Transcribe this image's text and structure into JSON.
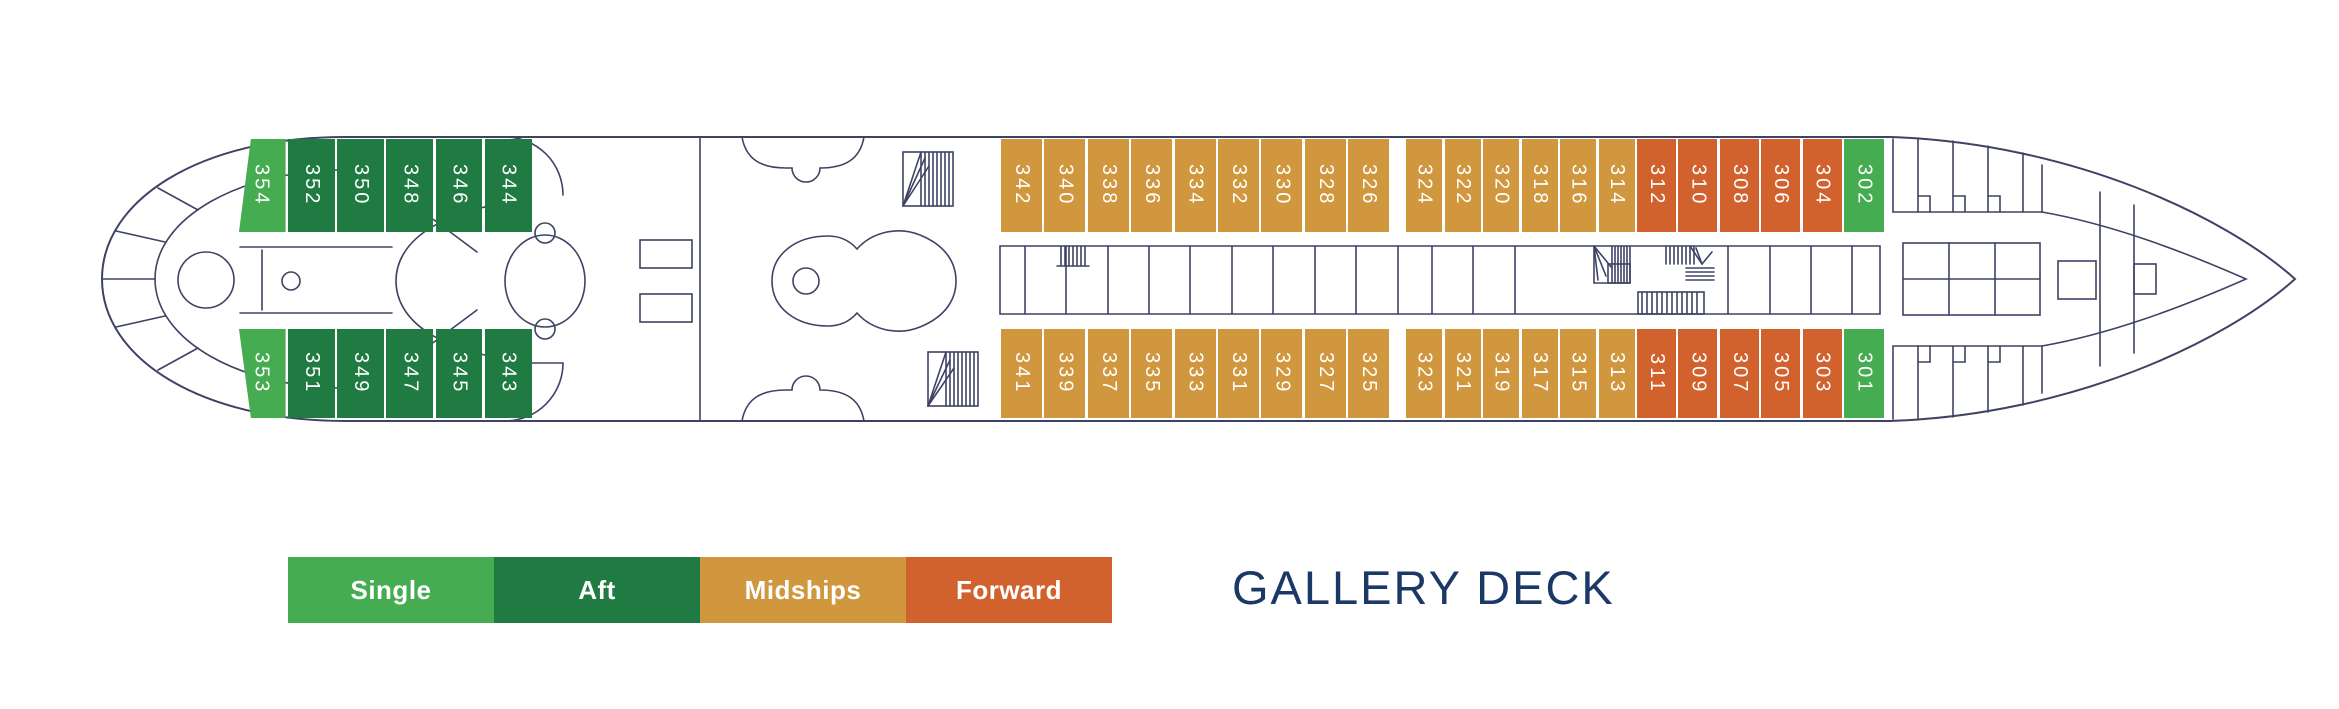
{
  "deck": {
    "title": "GALLERY DECK"
  },
  "colors": {
    "single": "#45AC51",
    "aft": "#1F7B41",
    "midships": "#D0973E",
    "forward": "#D1622E",
    "outline": "#3E4365",
    "title": "#1B3867"
  },
  "legend": {
    "items": [
      {
        "label": "Single",
        "category": "single"
      },
      {
        "label": "Aft",
        "category": "aft"
      },
      {
        "label": "Midships",
        "category": "midships"
      },
      {
        "label": "Forward",
        "category": "forward"
      }
    ]
  },
  "cabin_rows": [
    {
      "side": "port-top",
      "y": 139,
      "height": 93,
      "groups": [
        {
          "category": "single",
          "start": 236,
          "pitch": 52,
          "slant": "top-left",
          "cabins": [
            "354"
          ]
        },
        {
          "category": "aft",
          "start": 288,
          "pitch": 49.2,
          "cabins": [
            "352",
            "350",
            "348",
            "346",
            "344"
          ]
        },
        {
          "category": "midships",
          "start": 1001,
          "pitch": 43.4,
          "cabins": [
            "342",
            "340",
            "338",
            "336",
            "334",
            "332",
            "330",
            "328",
            "326"
          ]
        },
        {
          "category": "midships",
          "start": 1406,
          "pitch": 38.5,
          "cabins": [
            "324",
            "322",
            "320",
            "318",
            "316",
            "314"
          ]
        },
        {
          "category": "forward",
          "start": 1637,
          "pitch": 41.4,
          "cabins": [
            "312",
            "310",
            "308",
            "306",
            "304"
          ]
        },
        {
          "category": "single",
          "start": 1844,
          "pitch": 42,
          "cabins": [
            "302"
          ]
        }
      ]
    },
    {
      "side": "starboard-bottom",
      "y": 329,
      "height": 89,
      "groups": [
        {
          "category": "single",
          "start": 236,
          "pitch": 52,
          "slant": "bottom-left",
          "cabins": [
            "353"
          ]
        },
        {
          "category": "aft",
          "start": 288,
          "pitch": 49.2,
          "cabins": [
            "351",
            "349",
            "347",
            "345",
            "343"
          ]
        },
        {
          "category": "midships",
          "start": 1001,
          "pitch": 43.4,
          "cabins": [
            "341",
            "339",
            "337",
            "335",
            "333",
            "331",
            "329",
            "327",
            "325"
          ]
        },
        {
          "category": "midships",
          "start": 1406,
          "pitch": 38.5,
          "cabins": [
            "323",
            "321",
            "319",
            "317",
            "315",
            "313"
          ]
        },
        {
          "category": "forward",
          "start": 1637,
          "pitch": 41.4,
          "cabins": [
            "311",
            "309",
            "307",
            "305",
            "303"
          ]
        },
        {
          "category": "single",
          "start": 1844,
          "pitch": 42,
          "cabins": [
            "301"
          ]
        }
      ]
    }
  ]
}
